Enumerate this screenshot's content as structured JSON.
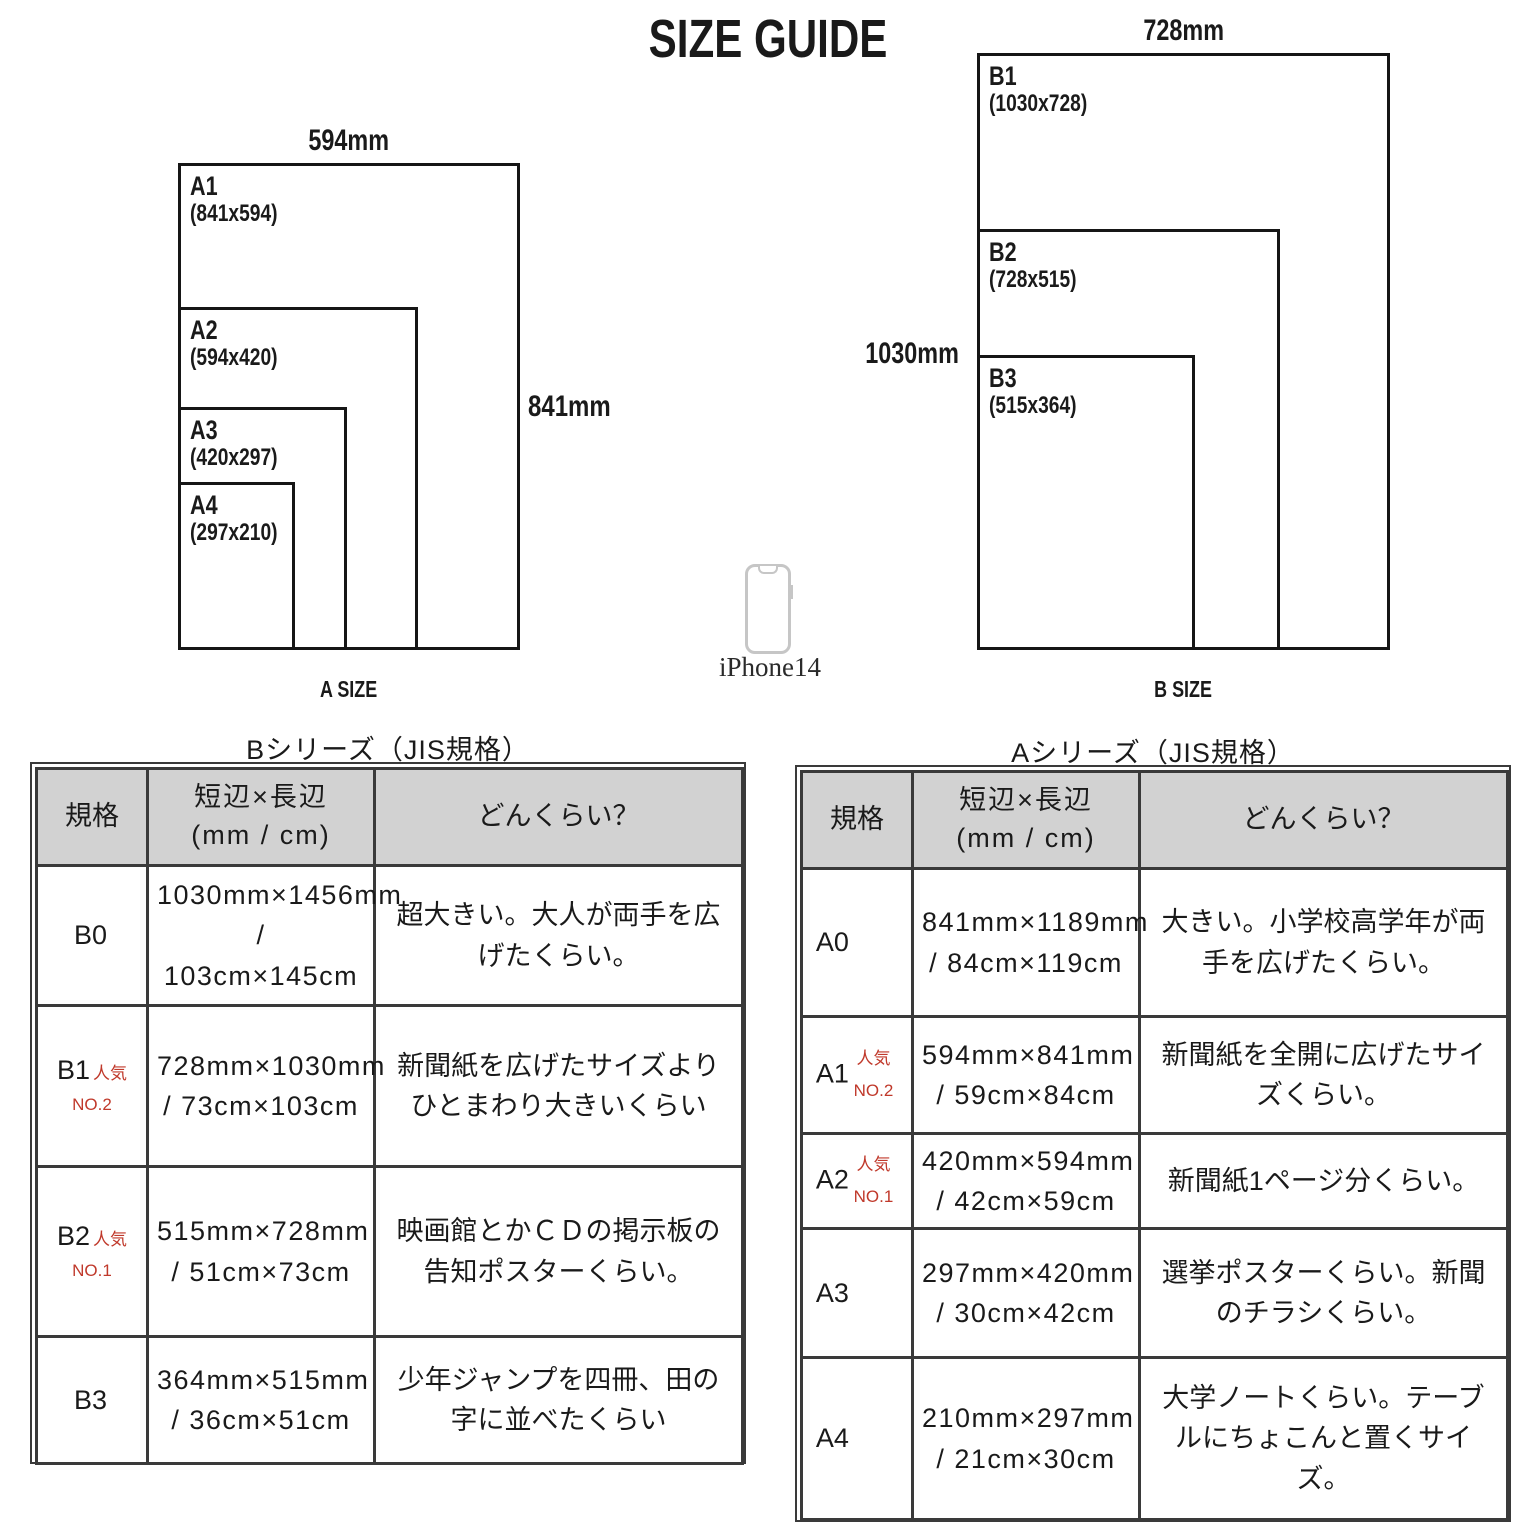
{
  "title": "SIZE GUIDE",
  "colors": {
    "badge_red": "#c0392b",
    "header_bg": "#d2d2d2",
    "line_black": "#161616",
    "table_border": "#3a3a3a"
  },
  "diagram_a": {
    "top_label": "594mm",
    "side_label": "841mm",
    "caption": "A SIZE",
    "sheets": [
      {
        "name": "A1",
        "dims": "(841x594)"
      },
      {
        "name": "A2",
        "dims": "(594x420)"
      },
      {
        "name": "A3",
        "dims": "(420x297)"
      },
      {
        "name": "A4",
        "dims": "(297x210)"
      }
    ]
  },
  "diagram_b": {
    "top_label": "728mm",
    "side_label": "1030mm",
    "caption": "B SIZE",
    "sheets": [
      {
        "name": "B1",
        "dims": "(1030x728)"
      },
      {
        "name": "B2",
        "dims": "(728x515)"
      },
      {
        "name": "B3",
        "dims": "(515x364)"
      }
    ]
  },
  "phone": {
    "label": "iPhone14"
  },
  "table_b": {
    "title": "Bシリーズ（JIS規格）",
    "headers": {
      "standard": "規格",
      "size_line1": "短辺×長辺",
      "size_line2": "(mm / cm)",
      "about": "どんくらい？"
    },
    "rows": [
      {
        "standard": "B0",
        "size": "1030mm×1456mm / 103cm×145cm",
        "about": "超大きい。大人が両手を広げたくらい。"
      },
      {
        "standard": "B1",
        "badge": "人気NO.2",
        "size": "728mm×1030mm / 73cm×103cm",
        "about": "新聞紙を広げたサイズよりひとまわり大きいくらい"
      },
      {
        "standard": "B2",
        "badge": "人気NO.1",
        "size": "515mm×728mm / 51cm×73cm",
        "about": "映画館とかＣＤの掲示板の告知ポスターくらい。"
      },
      {
        "standard": "B3",
        "size": "364mm×515mm / 36cm×51cm",
        "about": "少年ジャンプを四冊、田の字に並べたくらい"
      }
    ]
  },
  "table_a": {
    "title": "Aシリーズ（JIS規格）",
    "headers": {
      "standard": "規格",
      "size_line1": "短辺×長辺",
      "size_line2": "(mm / cm)",
      "about": "どんくらい？"
    },
    "rows": [
      {
        "standard": "A0",
        "size": "841mm×1189mm / 84cm×119cm",
        "about": "大きい。小学校高学年が両手を広げたくらい。"
      },
      {
        "standard": "A1",
        "badge": "人気NO.2",
        "size": "594mm×841mm / 59cm×84cm",
        "about": "新聞紙を全開に広げたサイズくらい。"
      },
      {
        "standard": "A2",
        "badge": "人気NO.1",
        "size": "420mm×594mm / 42cm×59cm",
        "about": "新聞紙1ページ分くらい。"
      },
      {
        "standard": "A3",
        "size": "297mm×420mm / 30cm×42cm",
        "about": "選挙ポスターくらい。新聞のチラシくらい。"
      },
      {
        "standard": "A4",
        "size": "210mm×297mm / 21cm×30cm",
        "about": "大学ノートくらい。テーブルにちょこんと置くサイズ。"
      }
    ]
  }
}
